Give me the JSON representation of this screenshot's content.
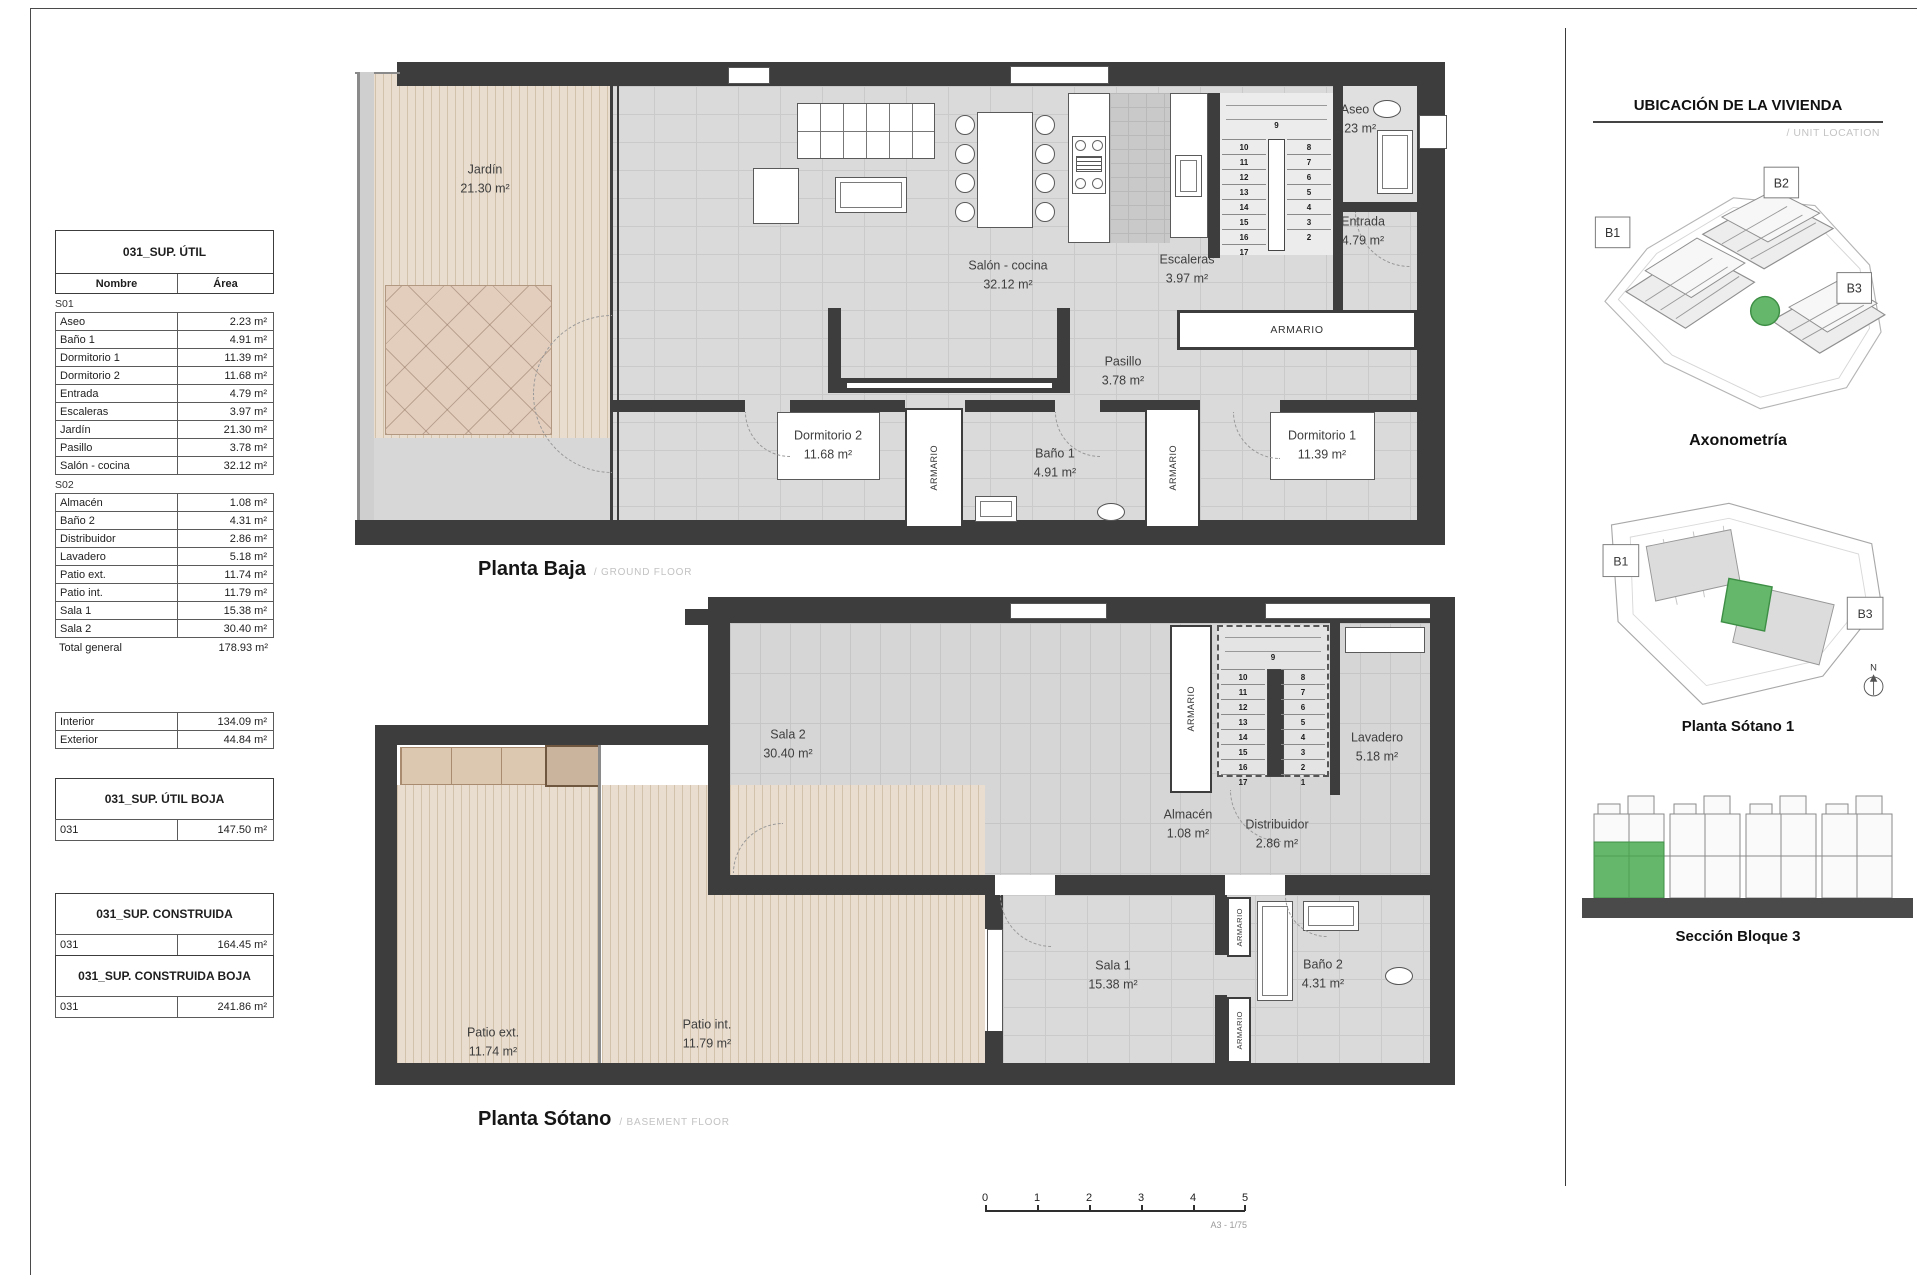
{
  "sheet": {
    "scale_ticks": [
      "0",
      "1",
      "2",
      "3",
      "4",
      "5"
    ],
    "scale_note": "A3 - 1/75"
  },
  "labels": {
    "armario": "ARMARIO"
  },
  "area_tables": {
    "util": {
      "title": "031_SUP. ÚTIL",
      "columns": {
        "name": "Nombre",
        "area": "Área"
      },
      "sections": [
        {
          "label": "S01",
          "rows": [
            {
              "name": "Aseo",
              "area": "2.23 m²"
            },
            {
              "name": "Baño 1",
              "area": "4.91 m²"
            },
            {
              "name": "Dormitorio 1",
              "area": "11.39 m²"
            },
            {
              "name": "Dormitorio 2",
              "area": "11.68 m²"
            },
            {
              "name": "Entrada",
              "area": "4.79 m²"
            },
            {
              "name": "Escaleras",
              "area": "3.97 m²"
            },
            {
              "name": "Jardín",
              "area": "21.30 m²"
            },
            {
              "name": "Pasillo",
              "area": "3.78 m²"
            },
            {
              "name": "Salón - cocina",
              "area": "32.12 m²"
            }
          ]
        },
        {
          "label": "S02",
          "rows": [
            {
              "name": "Almacén",
              "area": "1.08 m²"
            },
            {
              "name": "Baño 2",
              "area": "4.31 m²"
            },
            {
              "name": "Distribuidor",
              "area": "2.86 m²"
            },
            {
              "name": "Lavadero",
              "area": "5.18 m²"
            },
            {
              "name": "Patio ext.",
              "area": "11.74 m²"
            },
            {
              "name": "Patio int.",
              "area": "11.79 m²"
            },
            {
              "name": "Sala 1",
              "area": "15.38 m²"
            },
            {
              "name": "Sala 2",
              "area": "30.40 m²"
            }
          ]
        }
      ],
      "total": {
        "name": "Total general",
        "area": "178.93 m²"
      },
      "breakdown": [
        {
          "name": "Interior",
          "area": "134.09 m²"
        },
        {
          "name": "Exterior",
          "area": "44.84 m²"
        }
      ]
    },
    "util_boja": {
      "title": "031_SUP. ÚTIL BOJA",
      "row": {
        "name": "031",
        "area": "147.50 m²"
      }
    },
    "construida": {
      "title": "031_SUP. CONSTRUIDA",
      "row": {
        "name": "031",
        "area": "164.45 m²"
      }
    },
    "construida_boja": {
      "title": "031_SUP. CONSTRUIDA BOJA",
      "row": {
        "name": "031",
        "area": "241.86 m²"
      }
    }
  },
  "ground_floor": {
    "title": "Planta Baja",
    "subtitle": "/ GROUND FLOOR",
    "rooms": {
      "jardin": {
        "name": "Jardín",
        "area": "21.30 m²"
      },
      "salon": {
        "name": "Salón - cocina",
        "area": "32.12 m²"
      },
      "escaleras": {
        "name": "Escaleras",
        "area": "3.97 m²"
      },
      "aseo": {
        "name": "Aseo",
        "area": "2.23 m²"
      },
      "entrada": {
        "name": "Entrada",
        "area": "4.79 m²"
      },
      "pasillo": {
        "name": "Pasillo",
        "area": "3.78 m²"
      },
      "dormitorio2": {
        "name": "Dormitorio 2",
        "area": "11.68 m²"
      },
      "bano1": {
        "name": "Baño 1",
        "area": "4.91 m²"
      },
      "dormitorio1": {
        "name": "Dormitorio 1",
        "area": "11.39 m²"
      }
    },
    "stairs": {
      "top": "9",
      "left": [
        "10",
        "11",
        "12",
        "13",
        "14",
        "15",
        "16",
        "17"
      ],
      "right": [
        "8",
        "7",
        "6",
        "5",
        "4",
        "3",
        "2"
      ]
    }
  },
  "basement_floor": {
    "title": "Planta Sótano",
    "subtitle": "/ BASEMENT FLOOR",
    "rooms": {
      "sala2": {
        "name": "Sala 2",
        "area": "30.40 m²"
      },
      "lavadero": {
        "name": "Lavadero",
        "area": "5.18 m²"
      },
      "almacen": {
        "name": "Almacén",
        "area": "1.08 m²"
      },
      "distribuidor": {
        "name": "Distribuidor",
        "area": "2.86 m²"
      },
      "patio_ext": {
        "name": "Patio ext.",
        "area": "11.74 m²"
      },
      "patio_int": {
        "name": "Patio int.",
        "area": "11.79 m²"
      },
      "sala1": {
        "name": "Sala 1",
        "area": "15.38 m²"
      },
      "bano2": {
        "name": "Baño 2",
        "area": "4.31 m²"
      }
    },
    "stairs": {
      "top": "9",
      "left": [
        "10",
        "11",
        "12",
        "13",
        "14",
        "15",
        "16",
        "17"
      ],
      "right": [
        "8",
        "7",
        "6",
        "5",
        "4",
        "3",
        "2",
        "1"
      ]
    }
  },
  "location_panel": {
    "header": "UBICACIÓN DE LA VIVIENDA",
    "subheader": "/ UNIT LOCATION",
    "highlight_color": "#65b86b",
    "axonometry": {
      "caption": "Axonometría",
      "blocks": [
        "B1",
        "B2",
        "B3"
      ]
    },
    "siteplan": {
      "caption": "Planta Sótano 1",
      "blocks": [
        "B1",
        "B3"
      ],
      "north": "N"
    },
    "section": {
      "caption": "Sección Bloque 3"
    }
  }
}
